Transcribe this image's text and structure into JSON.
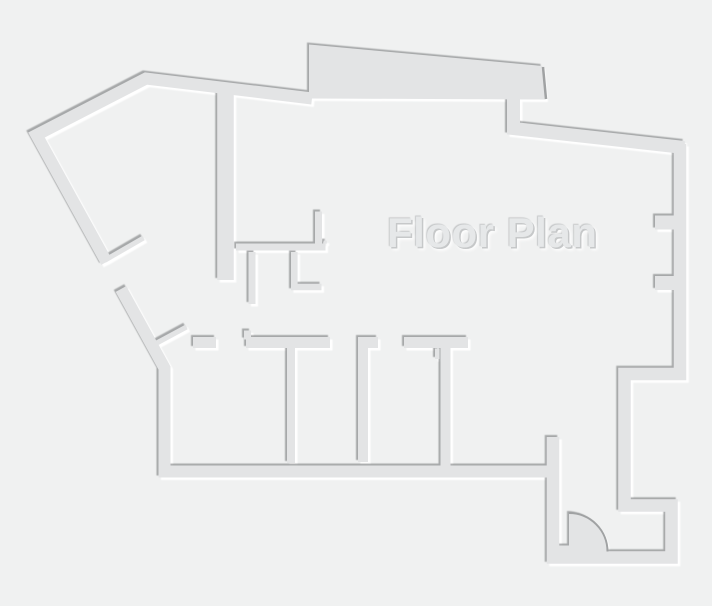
{
  "title": "Floor Plan",
  "colors": {
    "background": "#f0f1f1",
    "wall_fill": "#e3e4e5",
    "wall_shadow": "#a0a2a3",
    "wall_highlight": "#ffffff",
    "title_color": "#e6e8e9",
    "title_shadow_dark": "#c6c8c9"
  }
}
